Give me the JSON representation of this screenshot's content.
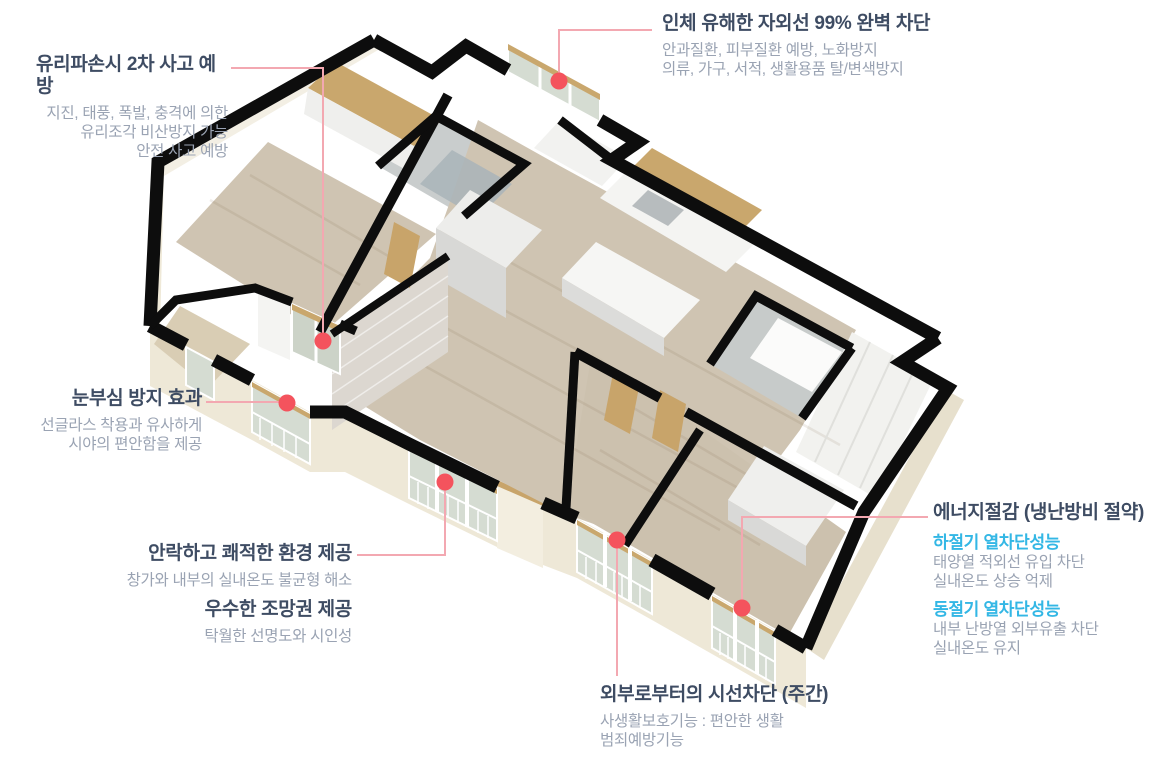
{
  "palette": {
    "title_navy": "#3e4c63",
    "body_gray": "#9aa3b3",
    "season_cyan": "#33b7e5",
    "leader_pink": "#f3a8b1",
    "marker_red": "#f4535d",
    "wall_black": "#0d0d0d",
    "exterior_cream": "#eee8d7",
    "floor_wood": "#cfc4b2"
  },
  "annotations": {
    "uv": {
      "title": "인체 유해한 자외선 99% 완벽 차단",
      "lines": [
        "안과질환, 피부질환 예방, 노화방지",
        "의류, 가구, 서적, 생활용품 탈/변색방지"
      ]
    },
    "breakage": {
      "title": "유리파손시 2차 사고 예방",
      "lines": [
        "지진, 태풍, 폭발, 충격에 의한",
        "유리조각 비산방지 가능",
        "안전 사고 예방"
      ]
    },
    "glare": {
      "title": "눈부심 방지 효과",
      "lines": [
        "선글라스 착용과 유사하게",
        "시야의 편안함을 제공"
      ]
    },
    "comfort": {
      "title": "안락하고 쾌적한 환경 제공",
      "lines": [
        "창가와 내부의 실내온도 불균형 해소"
      ]
    },
    "view": {
      "title": "우수한 조망권 제공",
      "lines": [
        "탁월한 선명도와 시인성"
      ]
    },
    "privacy": {
      "title": "외부로부터의 시선차단 (주간)",
      "lines": [
        "사생활보호기능 : 편안한 생활",
        "범죄예방기능"
      ]
    },
    "energy": {
      "title": "에너지절감 (냉난방비 절약)",
      "sections": [
        {
          "heading": "하절기 열차단성능",
          "lines": [
            "태양열 적외선 유입 차단",
            "실내온도 상승 억제"
          ]
        },
        {
          "heading": "동절기 열차단성능",
          "lines": [
            "내부 난방열 외부유출 차단",
            "실내온도 유지"
          ]
        }
      ]
    }
  }
}
